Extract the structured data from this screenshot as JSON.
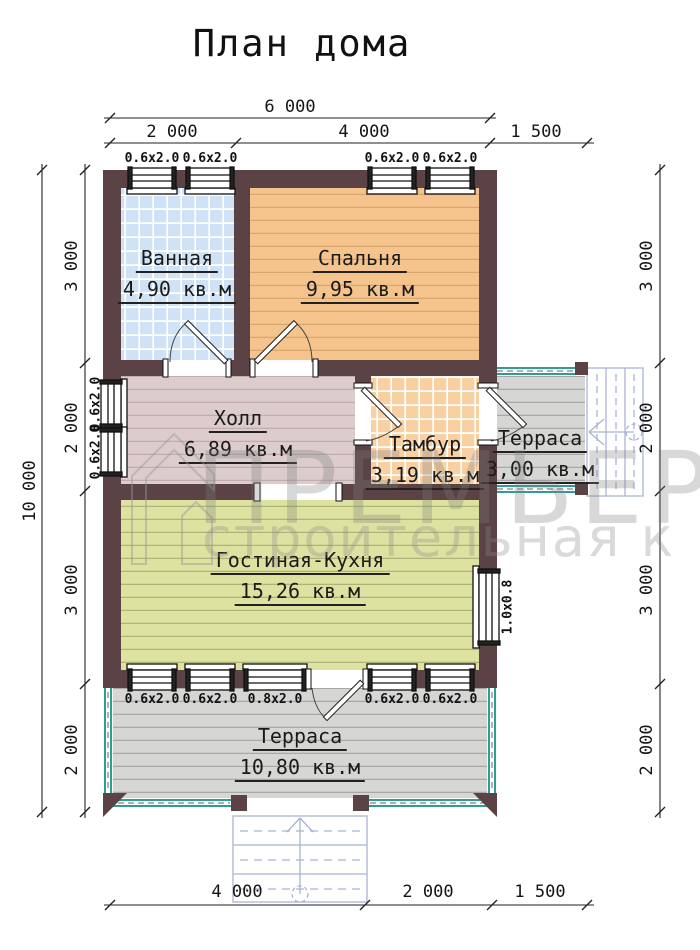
{
  "title": "План дома",
  "watermark": {
    "line1": "ПРЕМЬЕР",
    "line2": "строительная к"
  },
  "rooms": [
    {
      "id": "bathroom",
      "name": "Ванная",
      "area": "4,90 кв.м"
    },
    {
      "id": "bedroom",
      "name": "Спальня",
      "area": "9,95 кв.м"
    },
    {
      "id": "hall",
      "name": "Холл",
      "area": "6,89 кв.м"
    },
    {
      "id": "tambour",
      "name": "Тамбур",
      "area": "3,19 кв.м"
    },
    {
      "id": "terrace-side",
      "name": "Терраса",
      "area": "3,00 кв.м"
    },
    {
      "id": "living-kitchen",
      "name": "Гостиная-Кухня",
      "area": "15,26 кв.м"
    },
    {
      "id": "terrace-bottom",
      "name": "Терраса",
      "area": "10,80 кв.м"
    }
  ],
  "dimensions": {
    "top_total": "6 000",
    "top_segments": [
      "2 000",
      "4 000",
      "1 500"
    ],
    "left_total": "10 000",
    "left_segments": [
      "3 000",
      "2 000",
      "3 000",
      "2 000"
    ],
    "right_segments": [
      "3 000",
      "2 000",
      "3 000",
      "2 000"
    ],
    "bottom_segments": [
      "4 000",
      "2 000",
      "1 500"
    ]
  },
  "windows": {
    "top": [
      "0.6x2.0",
      "0.6x2.0",
      "0.6x2.0",
      "0.6x2.0"
    ],
    "left": [
      "0.6x2.0",
      "0.6x2.0"
    ],
    "right": [
      "1.0x0.8"
    ],
    "bottom": [
      "0.6x2.0",
      "0.6x2.0",
      "0.8x2.0",
      "0.6x2.0",
      "0.6x2.0"
    ]
  },
  "colors": {
    "wall": "#5b4244",
    "bathroom_floor": "#cfe2f6",
    "bedroom_floor": "#f5c48c",
    "hall_floor": "#dccccc",
    "tambour_floor": "#f8d0a2",
    "living_floor": "#dde2a0",
    "terrace_floor": "#d6d6d4",
    "railing": "#2f9d94",
    "stairs": "#aab3d4",
    "line": "#222222"
  }
}
